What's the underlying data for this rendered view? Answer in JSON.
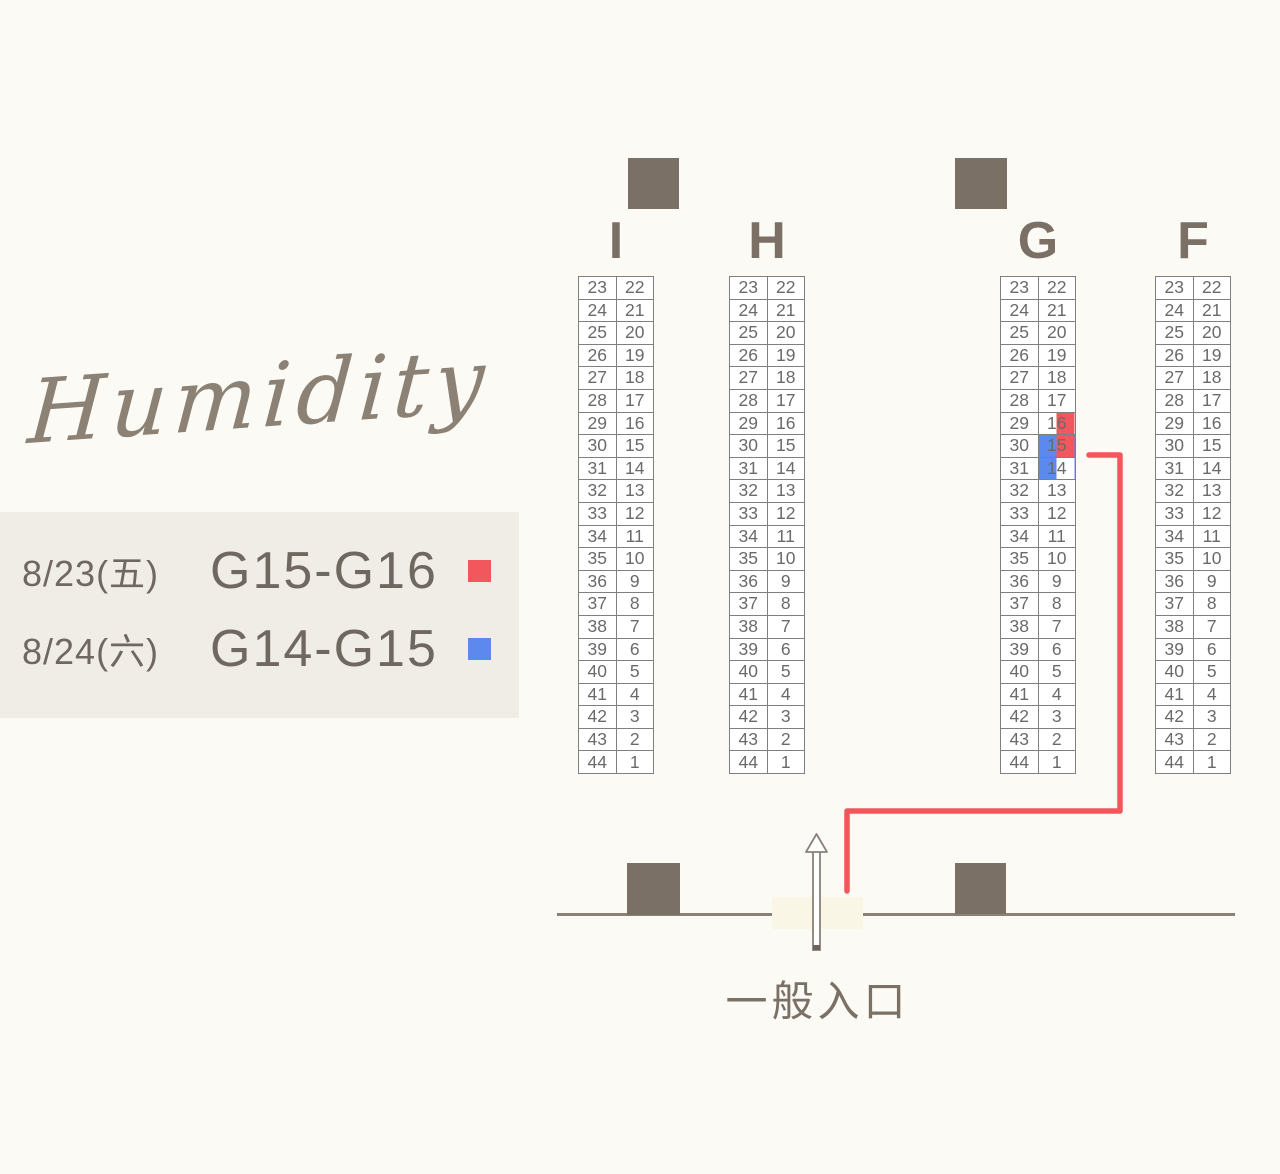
{
  "logo": {
    "text": "Humidity"
  },
  "legend": {
    "rows": [
      {
        "date": "8/23(五)",
        "booths": "G15-G16",
        "color_key": "red"
      },
      {
        "date": "8/24(六)",
        "booths": "G14-G15",
        "color_key": "blue"
      }
    ]
  },
  "map": {
    "colors": {
      "red": "#f2575d",
      "blue": "#5c89ee",
      "pillar": "#7b7066",
      "wall": "#8a8178"
    },
    "columns": [
      {
        "label": "I"
      },
      {
        "label": "H"
      },
      {
        "label": "G"
      },
      {
        "label": "F"
      }
    ],
    "rows": [
      [
        23,
        22
      ],
      [
        24,
        21
      ],
      [
        25,
        20
      ],
      [
        26,
        19
      ],
      [
        27,
        18
      ],
      [
        28,
        17
      ],
      [
        29,
        16
      ],
      [
        30,
        15
      ],
      [
        31,
        14
      ],
      [
        32,
        13
      ],
      [
        33,
        12
      ],
      [
        34,
        11
      ],
      [
        35,
        10
      ],
      [
        36,
        9
      ],
      [
        37,
        8
      ],
      [
        38,
        7
      ],
      [
        39,
        6
      ],
      [
        40,
        5
      ],
      [
        41,
        4
      ],
      [
        42,
        3
      ],
      [
        43,
        2
      ],
      [
        44,
        1
      ]
    ],
    "highlights": [
      {
        "column": "G",
        "seat": 16,
        "half": "right",
        "color_key": "red"
      },
      {
        "column": "G",
        "seat": 15,
        "half": "left",
        "color_key": "blue"
      },
      {
        "column": "G",
        "seat": 15,
        "half": "right",
        "color_key": "red"
      },
      {
        "column": "G",
        "seat": 14,
        "half": "left",
        "color_key": "blue"
      }
    ],
    "entrance_label": "一般入口"
  }
}
